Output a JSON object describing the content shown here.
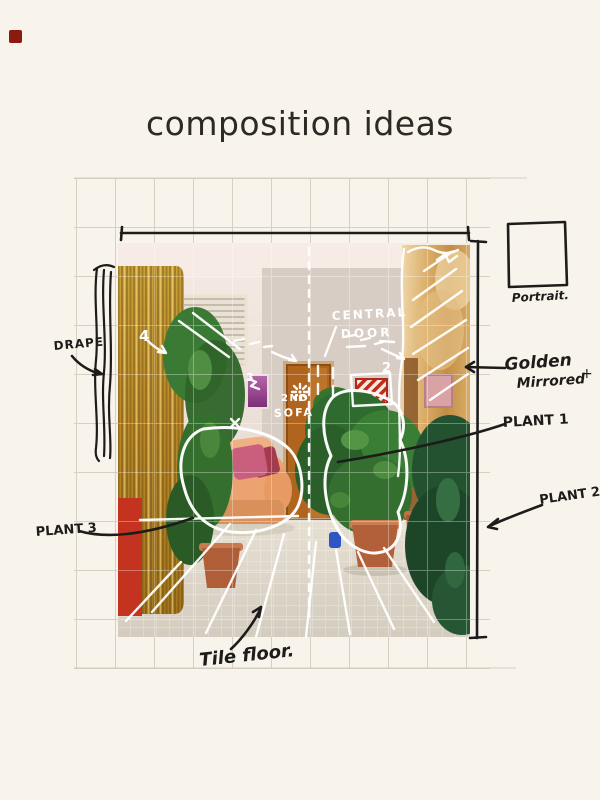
{
  "title": "composition ideas",
  "labels": {
    "drape": "DRAPE",
    "plant1": "PLANT 1",
    "plant2": "PLANT 2",
    "plant3": "PLANT 3",
    "tile_floor": "Tile floor.",
    "portrait": "Portrait.",
    "golden_mirrored_line1": "Golden",
    "golden_mirrored_line2": "Mirrored",
    "plus_mark": "+",
    "central_door_line1": "CENTRAL",
    "central_door_line2": "DOOR",
    "second_sofa_line1": "2ND",
    "second_sofa_line2": "SOFA",
    "number_4": "4",
    "number_3": "3",
    "number_2": "2"
  },
  "colors": {
    "background": "#f8f4ec",
    "ink": "#1d1c1a",
    "grid": "#cfc9bf",
    "title_text": "#2c2926",
    "red_square": "#8b1a10",
    "white_sketch": "#ffffff",
    "curtain_gold": "#b9892b",
    "red_wall": "#c43320",
    "mirror_gold": "#d9ad69",
    "plant_green": "#2f6a2e",
    "pot_terracotta": "#b2603a"
  }
}
